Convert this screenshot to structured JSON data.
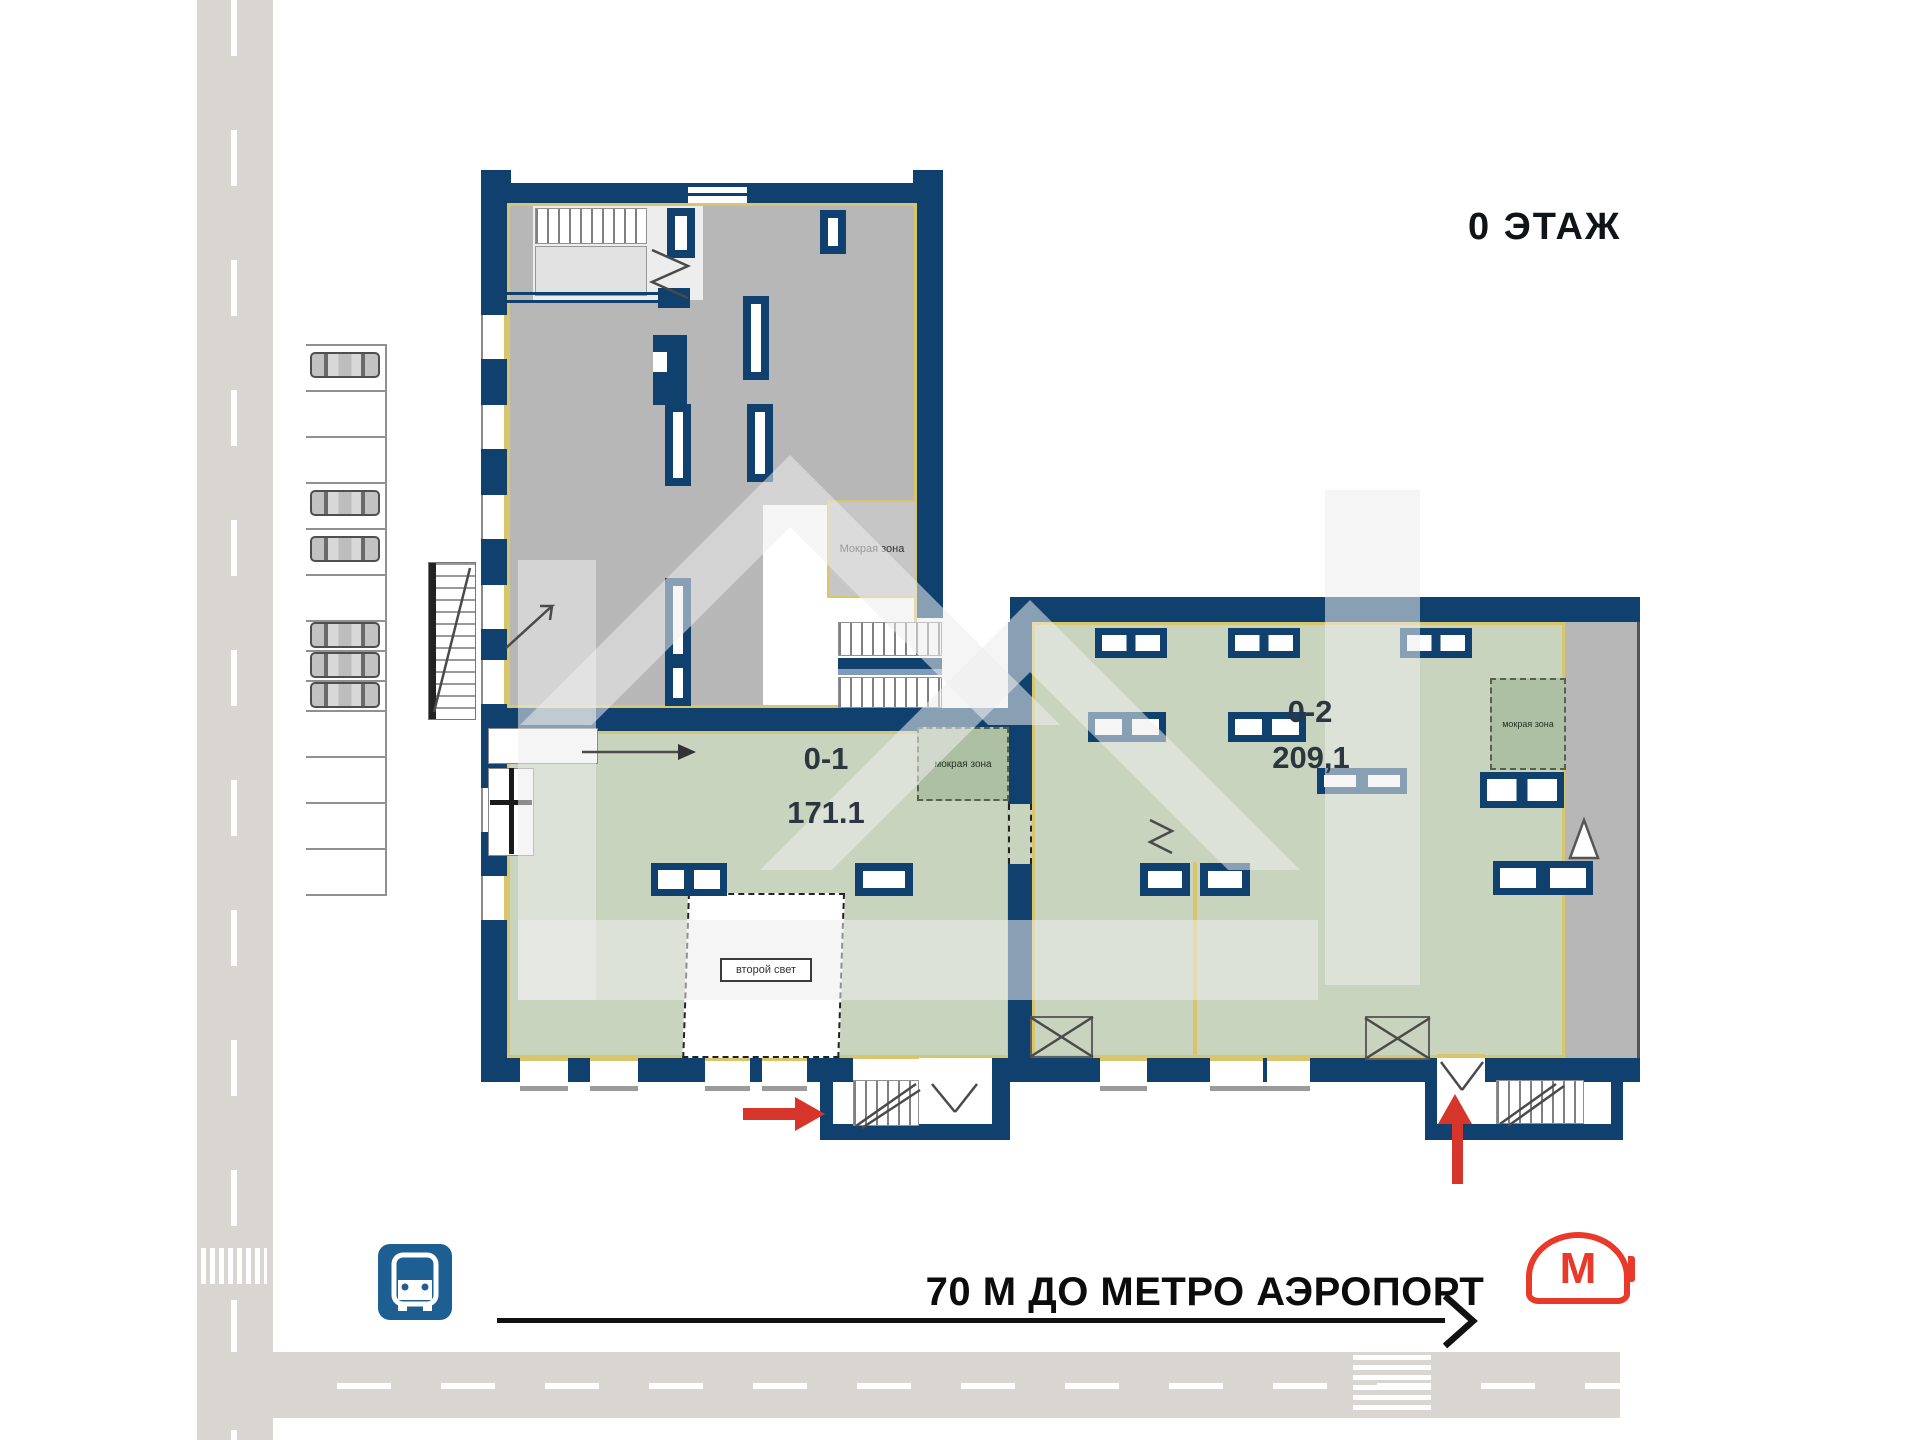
{
  "header": {
    "floor_label": "0 ЭТАЖ"
  },
  "units": [
    {
      "id": "0-1",
      "area": "171.1",
      "wet_zone_label": "мокрая зона",
      "second_light_label": "второй свет"
    },
    {
      "id": "0-2",
      "area": "209,1",
      "wet_zone_label": "мокрая зона"
    }
  ],
  "upper_unit": {
    "wet_zone_label": "Мокрая зона"
  },
  "footer": {
    "metro_distance_text": "70 М ДО МЕТРО АЭРОПОРТ",
    "metro_letter": "М"
  },
  "icons": [
    "bus-stop-icon",
    "moscow-metro-logo",
    "entrance-arrow-right",
    "entrance-arrow-up",
    "parked-car-icon",
    "crosswalk-marking",
    "stairs-glyph",
    "door-swing-glyph"
  ],
  "colors": {
    "wall_navy": "#10406e",
    "room_green": "#c9d4bf",
    "wet_zone_green": "#aec0a3",
    "tech_gray": "#b7b7b7",
    "outline_yellow": "#d9c56b",
    "road_gray": "#d9d5d1",
    "arrow_red": "#d5352b",
    "bus_blue": "#1d5f93",
    "metro_red": "#e8392a",
    "text_dark": "#101418"
  }
}
